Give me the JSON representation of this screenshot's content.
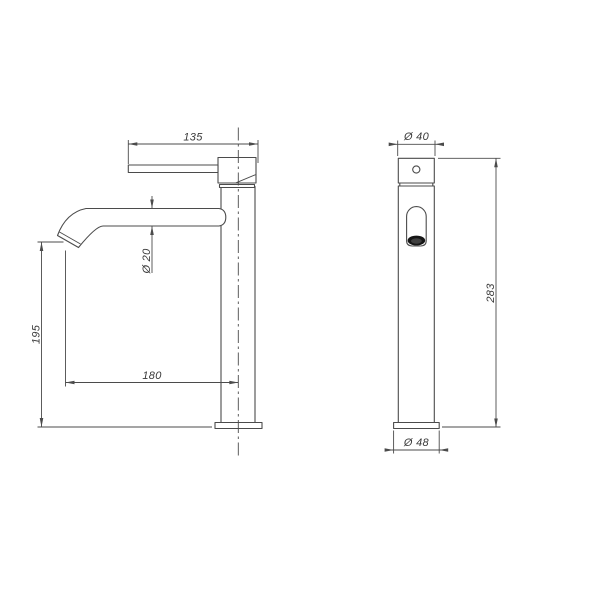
{
  "colors": {
    "background": "#ffffff",
    "line": "#4b4b4b",
    "text": "#3a3a3a",
    "aerator": "#161616",
    "aerator_inner": "#3f3f3f"
  },
  "side_view": {
    "dims": {
      "handle_length": "135",
      "spout_diameter": "Ø 20",
      "outlet_height": "195",
      "spout_reach": "180"
    }
  },
  "front_view": {
    "dims": {
      "top_diameter": "Ø 40",
      "total_height": "283",
      "base_diameter": "Ø 48"
    }
  }
}
